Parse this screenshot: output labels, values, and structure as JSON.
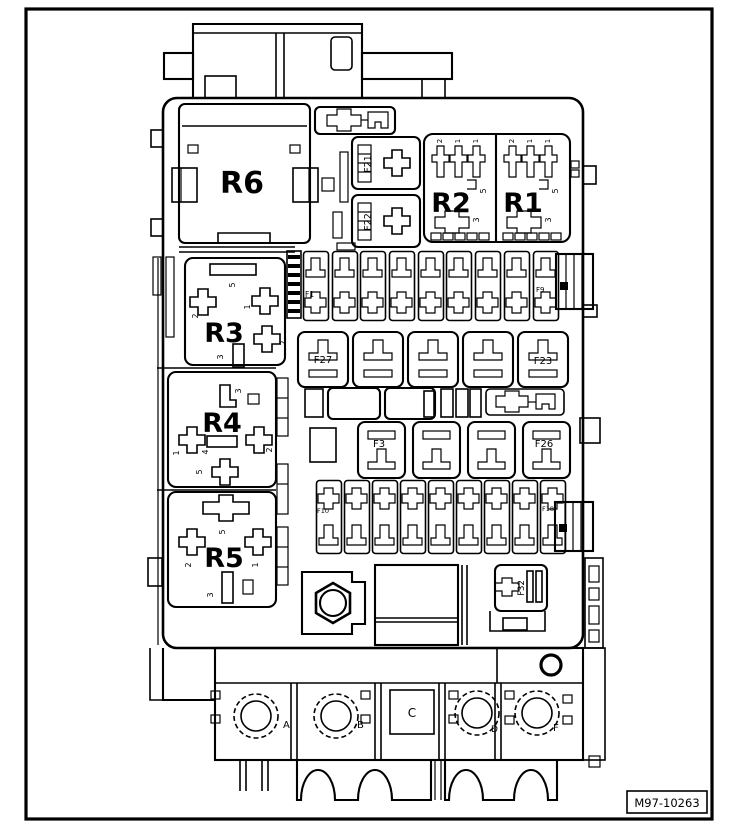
{
  "figure": {
    "id_label": "M97-10263"
  },
  "colors": {
    "background": "#ffffff",
    "line": "#000000"
  },
  "relays": {
    "r1": {
      "label": "R1",
      "pins_top": [
        "2",
        "1",
        "1"
      ],
      "pin_side": "5",
      "pin_bottom": "3"
    },
    "r2": {
      "label": "R2",
      "pins_top": [
        "2",
        "1",
        "1"
      ],
      "pin_side": "5",
      "pin_bottom": "3"
    },
    "r3": {
      "label": "R3",
      "pin_top": "5",
      "pin_left": "2",
      "pin_right": "1",
      "pin_lower_right": "2",
      "pin_bottom": "3"
    },
    "r4": {
      "label": "R4",
      "pin_top": "3",
      "pin_left": "1",
      "pin_center": "4",
      "pin_right": "2",
      "pin_bottom": "5"
    },
    "r5": {
      "label": "R5",
      "pin_top": "5",
      "pin_left": "2",
      "pin_right": "1",
      "pin_bottom": "3"
    },
    "r6": {
      "label": "R6"
    }
  },
  "fuses": {
    "f21": {
      "label": "F21"
    },
    "f22": {
      "label": "F22"
    },
    "f32": {
      "label": "F32"
    },
    "fuse_row_top": {
      "first_label": "F1",
      "last_label": "F9"
    },
    "fuse_row_bottom": {
      "first_label": "F10",
      "last_label": "F18"
    },
    "relay_row_upper": {
      "first_label": "F27",
      "last_label": "F23"
    },
    "relay_row_lower": {
      "first_label": "F3",
      "last_label": "F26"
    }
  },
  "terminals": {
    "a": "A",
    "b": "B",
    "c": "C",
    "d": "D",
    "f": "F"
  }
}
